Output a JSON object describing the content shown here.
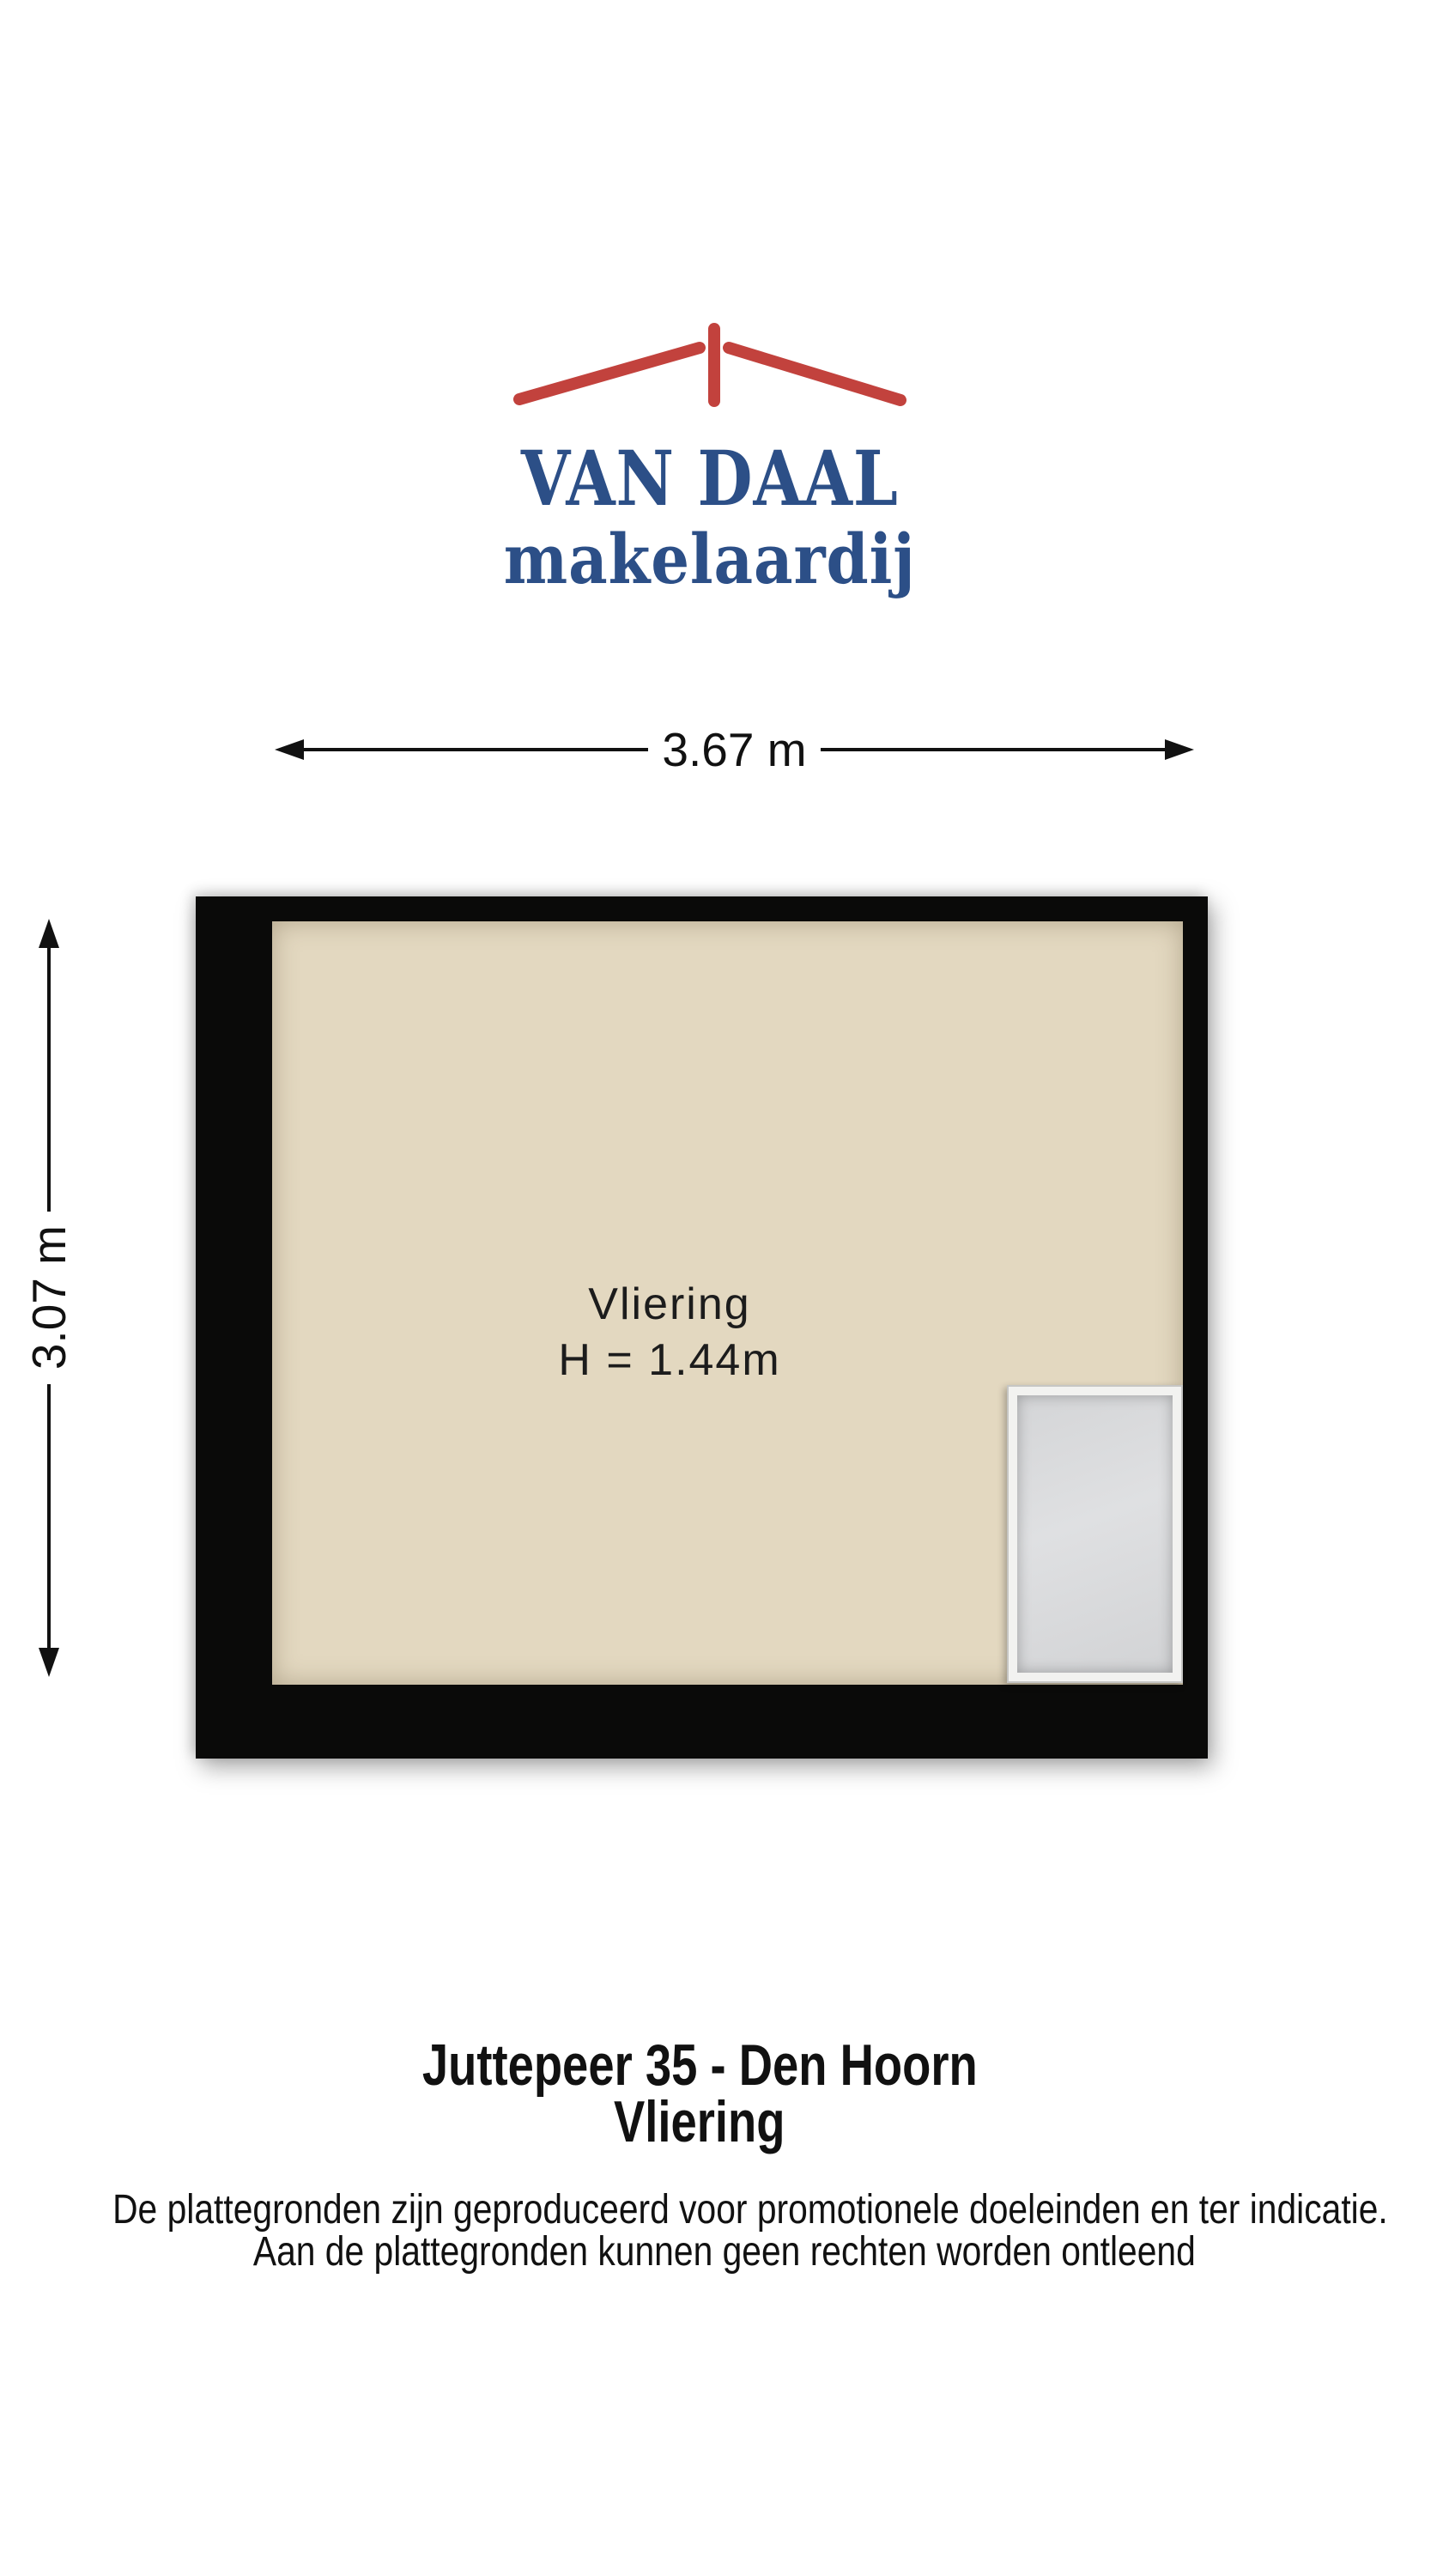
{
  "logo": {
    "line1": "VAN DAAL",
    "line2": "makelaardij"
  },
  "dimensions": {
    "width_label": "3.67 m",
    "height_label": "3.07 m"
  },
  "floorplan": {
    "room_label": "Vliering",
    "room_height_label": "H = 1.44m"
  },
  "title": {
    "line1": "Juttepeer 35 - Den Hoorn",
    "line2": "Vliering"
  },
  "disclaimer": {
    "line1": "De plattegronden zijn geproduceerd voor promotionele doeleinden en ter indicatie.",
    "line2": "Aan de plattegronden kunnen geen rechten worden ontleend"
  },
  "colors": {
    "accent_blue": "#2c4f87",
    "roof_red": "#c2423d",
    "wall_color": "#0a0a09",
    "floor_color": "#e3d8c0",
    "hatch_frame": "#f2f2f0",
    "hatch_fill": "#d8d9db",
    "dim_color": "#111111"
  }
}
